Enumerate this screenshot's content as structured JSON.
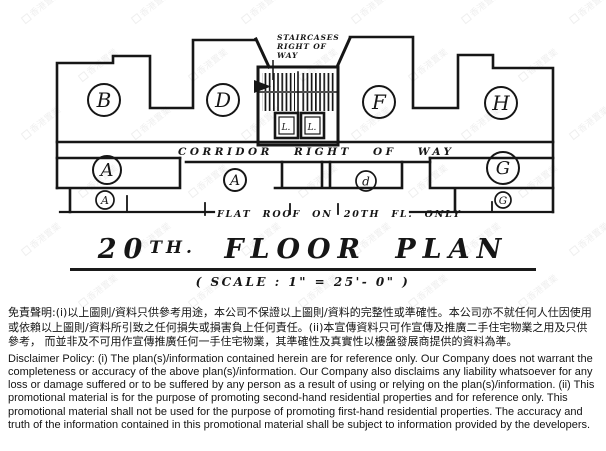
{
  "plan": {
    "units": {
      "b": "B",
      "d": "D",
      "f": "F",
      "h": "H",
      "a_large": "A",
      "a_medium": "A",
      "a_small": "A",
      "d_small": "d",
      "g_large": "G",
      "g_small": "G"
    },
    "lift_label": "L.",
    "staircase_label": [
      "STAIRCASES",
      "RIGHT OF",
      "WAY"
    ],
    "corridor_label": "CORRIDOR RIGHT OF WAY",
    "flat_roof_label": "FLAT ROOF ON 20TH FL. ONLY"
  },
  "title": {
    "num": "20",
    "sup": "TH.",
    "rest": "FLOOR PLAN",
    "scale": "( SCALE : 1\" = 25'- 0\" )"
  },
  "watermark": {
    "text": "香港置業"
  },
  "disclaimer": {
    "chinese": "免責聲明:(i)以上圖則/資料只供參考用途，本公司不保證以上圖則/資料的完整性或準確性。本公司亦不就任何人仕因使用或依賴以上圖則/資料所引致之任何損失或損害負上任何責任。(ii)本宣傳資料只可作宣傳及推廣二手住宅物業之用及只供參考， 而並非及不可用作宣傳推廣任何一手住宅物業，其準確性及真實性以樓盤發展商提供的資料為準。",
    "english": "Disclaimer Policy: (i) The plan(s)/information contained herein are for reference only. Our Company does not warrant the completeness or accuracy of the above plan(s)/information. Our Company also disclaims any liability whatsoever for any loss or damage suffered or to be suffered by any person as a result of using or relying on the plan(s)/information. (ii) This promotional material is for the purpose of promoting second-hand residential properties and for reference only. This promotional material shall not be used for the purpose of promoting first-hand residential properties. The accuracy and truth of the information contained in this promotional material shall be subject to information provided by the developers."
  }
}
